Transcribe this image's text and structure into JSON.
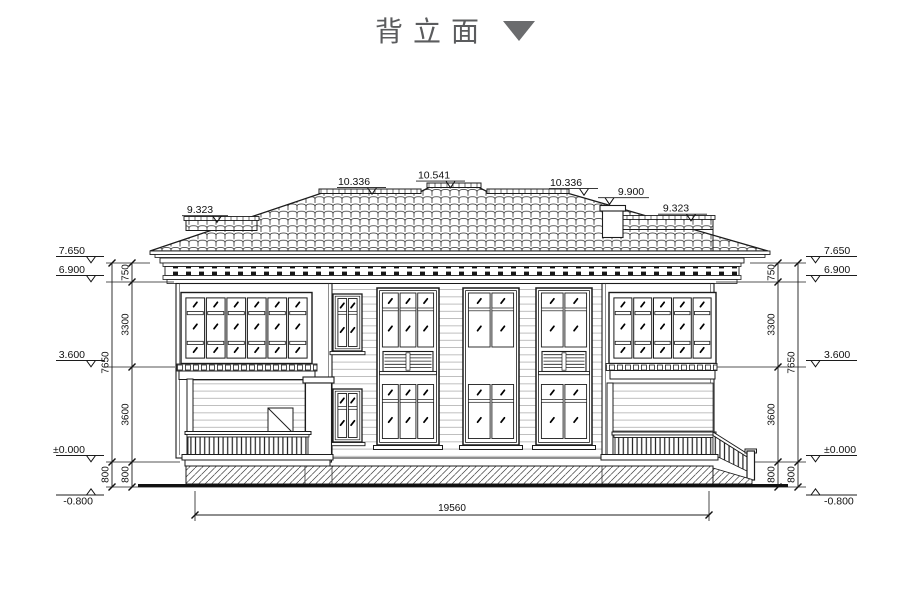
{
  "title": {
    "text": "背立面"
  },
  "roof_labels": {
    "left_wing_ridge": "9.323",
    "left_ridge": "10.336",
    "main_ridge": "10.541",
    "right_ridge": "10.336",
    "chimney_top": "9.900",
    "right_wing_ridge": "9.323"
  },
  "left_dimensions": {
    "levels": [
      "7.650",
      "6.900",
      "3.600",
      "±0.000",
      "-0.800"
    ],
    "segments": [
      "750",
      "3300",
      "3600",
      "800"
    ],
    "totals": [
      "7650",
      "800"
    ]
  },
  "right_dimensions": {
    "levels": [
      "7.650",
      "6.900",
      "3.600",
      "±0.000",
      "-0.800"
    ],
    "segments": [
      "750",
      "3300",
      "3600",
      "800"
    ],
    "totals": [
      "7650",
      "800"
    ]
  },
  "bottom_dimension": {
    "total_width": "19560"
  }
}
